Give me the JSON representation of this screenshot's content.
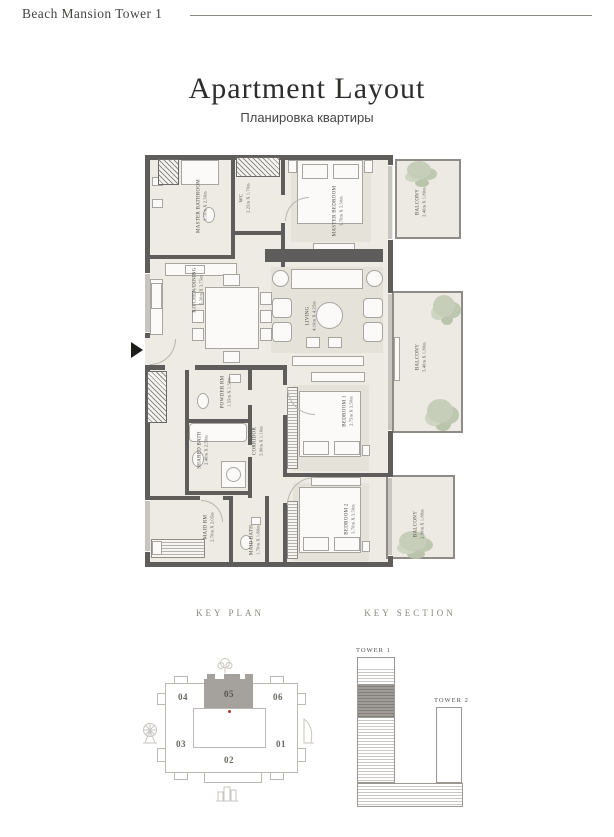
{
  "header": {
    "title": "Beach Mansion Tower 1"
  },
  "title": {
    "en": "Apartment Layout",
    "ru": "Планировка квартиры"
  },
  "plan": {
    "rooms": [
      {
        "name": "MASTER BATHROOM",
        "dims": "3.10m X 2.50m"
      },
      {
        "name": "WC",
        "dims": "2.25m X 1.70m"
      },
      {
        "name": "MASTER BEDROOM",
        "dims": "3.70m X 3.50m"
      },
      {
        "name": "KITCHEN/DINING",
        "dims": "5.30m X 3.75m"
      },
      {
        "name": "LIVING",
        "dims": "4.10m X 4.25m"
      },
      {
        "name": "POWDER RM",
        "dims": "1.55m X 1.50m"
      },
      {
        "name": "SHARED BATH",
        "dims": "2.40m X 2.50m"
      },
      {
        "name": "CORRIDOR",
        "dims": "5.90m X 1.10m"
      },
      {
        "name": "BEDROOM 1",
        "dims": "2.75m X 3.50m"
      },
      {
        "name": "BEDROOM 2",
        "dims": "3.70m X 3.50m"
      },
      {
        "name": "MAID RM",
        "dims": "2.70m X 2.05m"
      },
      {
        "name": "MAID BATH",
        "dims": "1.70m X 1.60m"
      },
      {
        "name": "BALCONY",
        "dims": "2.40m X 1.80m"
      },
      {
        "name": "BALCONY",
        "dims": "5.40m X 1.80m"
      },
      {
        "name": "BALCONY",
        "dims": "2.90m X 1.80m"
      }
    ]
  },
  "key_plan": {
    "heading": "KEY PLAN",
    "units": [
      "04",
      "05",
      "06",
      "03",
      "02",
      "01"
    ],
    "highlighted_unit": "05"
  },
  "key_section": {
    "heading": "KEY SECTION",
    "towers": [
      "TOWER 1",
      "TOWER 2"
    ],
    "highlighted_tower": "TOWER 1"
  },
  "colors": {
    "wall": "#5e5d5b",
    "floor": "#edebe4",
    "balcony_floor": "#eceae2",
    "plant": "#c5cdb8",
    "highlight_unit_fill": "#a5a19c",
    "red_dot": "#b03a30",
    "outline_gray": "#bcb9b4"
  }
}
